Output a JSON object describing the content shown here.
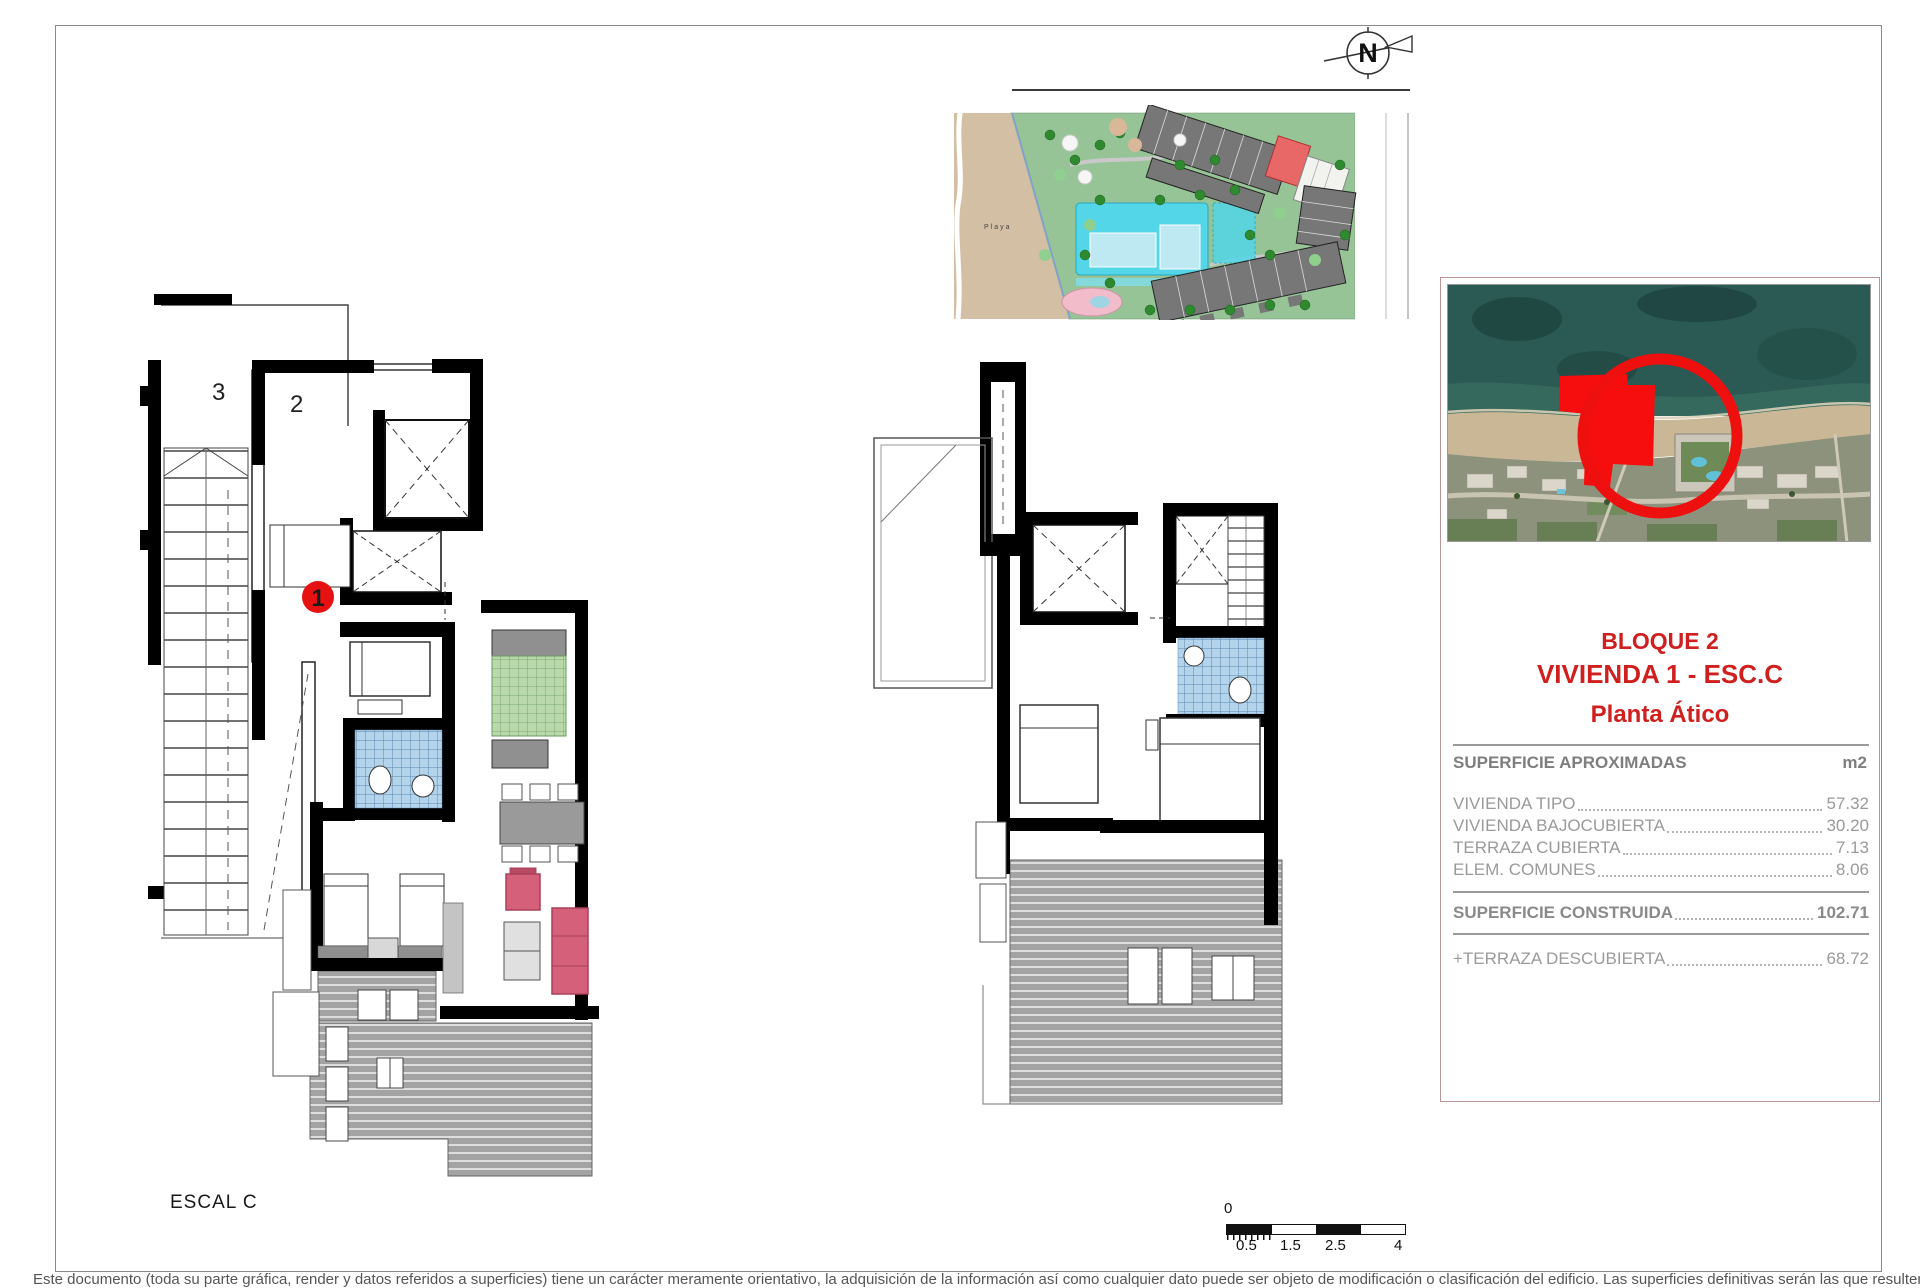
{
  "sheet": {
    "plan_caption": "ESCAL C",
    "disclaimer": "Este documento (toda su parte gráfica, render y datos referidos a superficies) tiene un carácter meramente orientativo, la adquisición de la información así como cualquier dato puede ser objeto de modificación o clasificación del edificio. Las superficies definitivas serán las que resulten de la ejecución final de la obra."
  },
  "north_arrow": {
    "label": "N"
  },
  "site_plan": {
    "beach_label": "Playa"
  },
  "floorplans": {
    "escal_c": {
      "unit_labels": [
        "3",
        "2"
      ],
      "highlight_label": "1"
    }
  },
  "info_panel": {
    "title_lines": [
      "BLOQUE 2",
      "VIVIENDA 1 - ESC.C",
      "Planta Ático"
    ],
    "areas": {
      "header": "SUPERFICIE APROXIMADAS",
      "unit": "m2",
      "rows": [
        {
          "label": "VIVIENDA TIPO",
          "value": "57.32"
        },
        {
          "label": "VIVIENDA BAJOCUBIERTA",
          "value": "30.20"
        },
        {
          "label": "TERRAZA CUBIERTA",
          "value": "7.13"
        },
        {
          "label": "ELEM. COMUNES",
          "value": "8.06"
        }
      ],
      "total_row": {
        "label": "SUPERFICIE CONSTRUIDA",
        "value": "102.71"
      },
      "extra_row": {
        "label": "+TERRAZA DESCUBIERTA",
        "value": "68.72"
      }
    }
  },
  "scale_bar": {
    "origin": "0",
    "tick_labels": [
      "0.5",
      "1.5",
      "2.5",
      "4"
    ]
  },
  "colors": {
    "accent_red": "#cf1f1f",
    "highlight_red": "#e61212",
    "table_text": "#9a9a9a",
    "panel_border": "#bb9595",
    "pool_cyan": "#52d6e8",
    "site_green": "#96c496",
    "beach_tan": "#d2bfa4"
  }
}
